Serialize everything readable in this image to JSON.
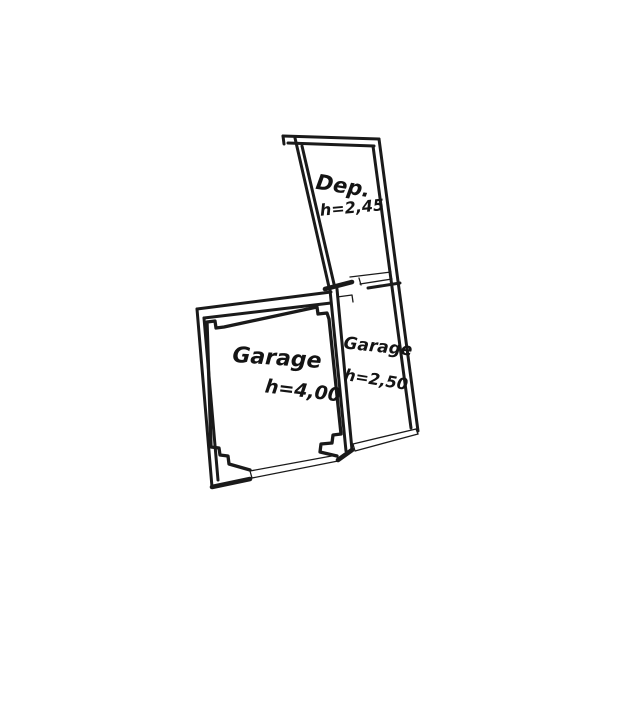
{
  "page": {
    "background": "#ffffff",
    "ink": "#1a1a1a",
    "type": "hand-drawn floor plan sketch"
  },
  "plan": {
    "rooms": [
      {
        "id": "dep",
        "label": "Dep.",
        "height": "h=2,45"
      },
      {
        "id": "garage-main",
        "label": "Garage",
        "height": "h=4,00"
      },
      {
        "id": "garage-small",
        "label": "Garage",
        "height": "h=2,50"
      }
    ]
  }
}
